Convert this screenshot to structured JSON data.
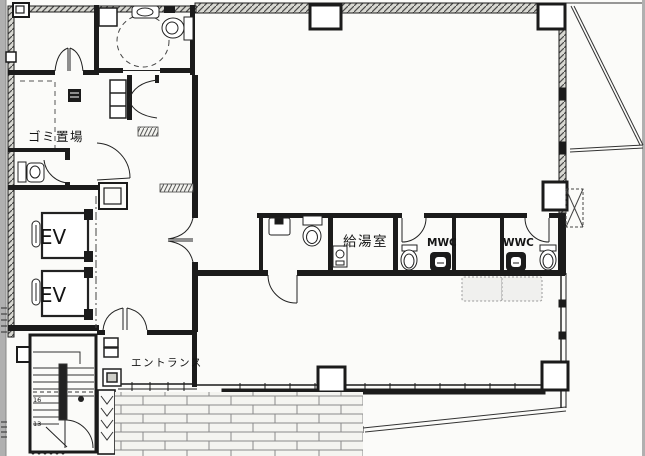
{
  "floorplan": {
    "labels": {
      "garbage_room": "ゴミ置場",
      "elevator_1": "EV",
      "elevator_2": "EV",
      "entrance": "エントランス",
      "kitchenette": "給湯室",
      "mens_wc": "MWC",
      "womens_wc": "WWC",
      "stair_count_upper": "16",
      "stair_count_lower": "13"
    },
    "colors": {
      "paper": "#fbfbf9",
      "wall": "#1b1b1b",
      "wall_hatch": "#d8d8d2",
      "scan_border": "#b0b0b0",
      "brick_line": "#8a8a8a"
    }
  }
}
